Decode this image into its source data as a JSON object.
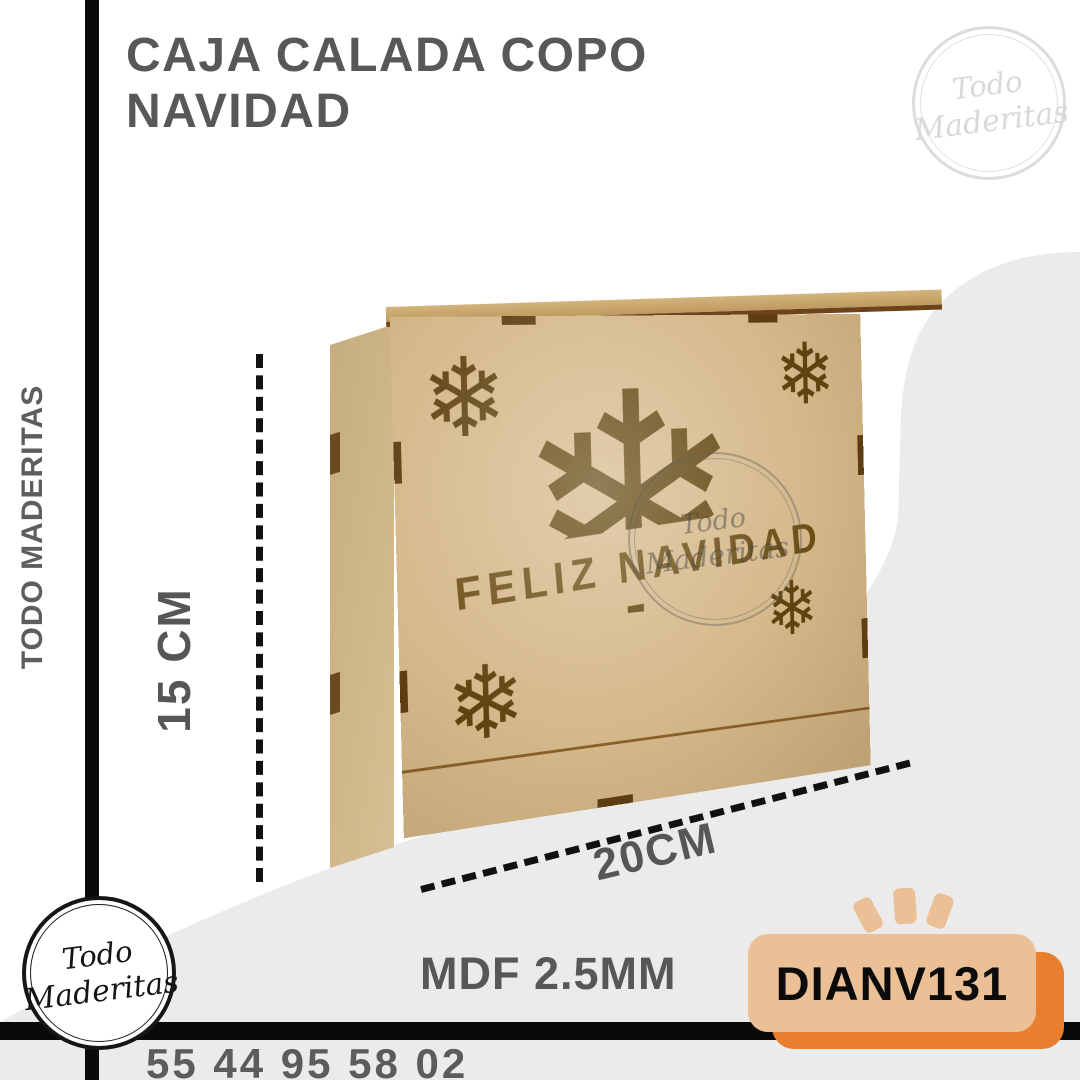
{
  "header": {
    "title": "CAJA CALADA COPO NAVIDAD"
  },
  "brand": {
    "vertical_label": "TODO MADERITAS",
    "logo_line1": "Todo",
    "logo_line2": "Maderitas"
  },
  "dimensions": {
    "height_label": "15 CM",
    "width_label": "20CM"
  },
  "product": {
    "engraving": "FELIZ NAVIDAD",
    "snowflake_glyph": "❄",
    "material": "MDF 2.5MM",
    "sku": "DIANV131"
  },
  "footer": {
    "phone": "55 44 95 58 02"
  },
  "colors": {
    "background_gray": "#ebebeb",
    "frame_black": "#0a0a0a",
    "text_gray": "#585858",
    "wood_tan": "#d5b88a",
    "cutout_brown": "#5f430f",
    "badge_peach": "#ecc096",
    "badge_orange": "#e87e2e"
  }
}
